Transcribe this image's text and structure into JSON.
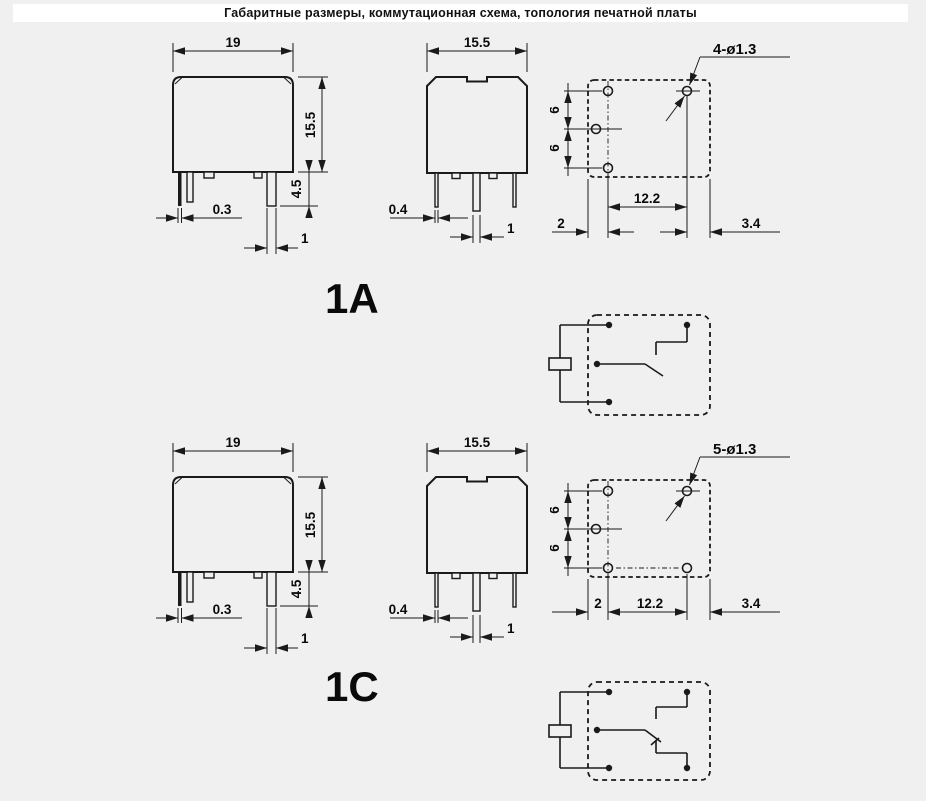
{
  "colors": {
    "background": "#f0f0f0",
    "line": "#1a1a1a",
    "panel": "#ffffff"
  },
  "header": {
    "title": "Габаритные размеры, коммутационная схема, топология печатной платы"
  },
  "sections": [
    {
      "label": "1A",
      "front": {
        "width": "19",
        "height": "15.5",
        "pin_length": "4.5",
        "pin_thickness": "0.3",
        "pin_width": "1"
      },
      "side": {
        "width": "15.5",
        "pin_thickness": "0.4",
        "pin_width": "1"
      },
      "pcb": {
        "holes_label": "4-ø1.3",
        "row_pitch_top": "6",
        "row_pitch_bottom": "6",
        "col_pitch": "12.2",
        "edge_left": "2",
        "edge_right": "3.4"
      }
    },
    {
      "label": "1C",
      "front": {
        "width": "19",
        "height": "15.5",
        "pin_length": "4.5",
        "pin_thickness": "0.3",
        "pin_width": "1"
      },
      "side": {
        "width": "15.5",
        "pin_thickness": "0.4",
        "pin_width": "1"
      },
      "pcb": {
        "holes_label": "5-ø1.3",
        "row_pitch_top": "6",
        "row_pitch_bottom": "6",
        "col_pitch": "12.2",
        "edge_left": "2",
        "edge_right": "3.4"
      }
    }
  ]
}
